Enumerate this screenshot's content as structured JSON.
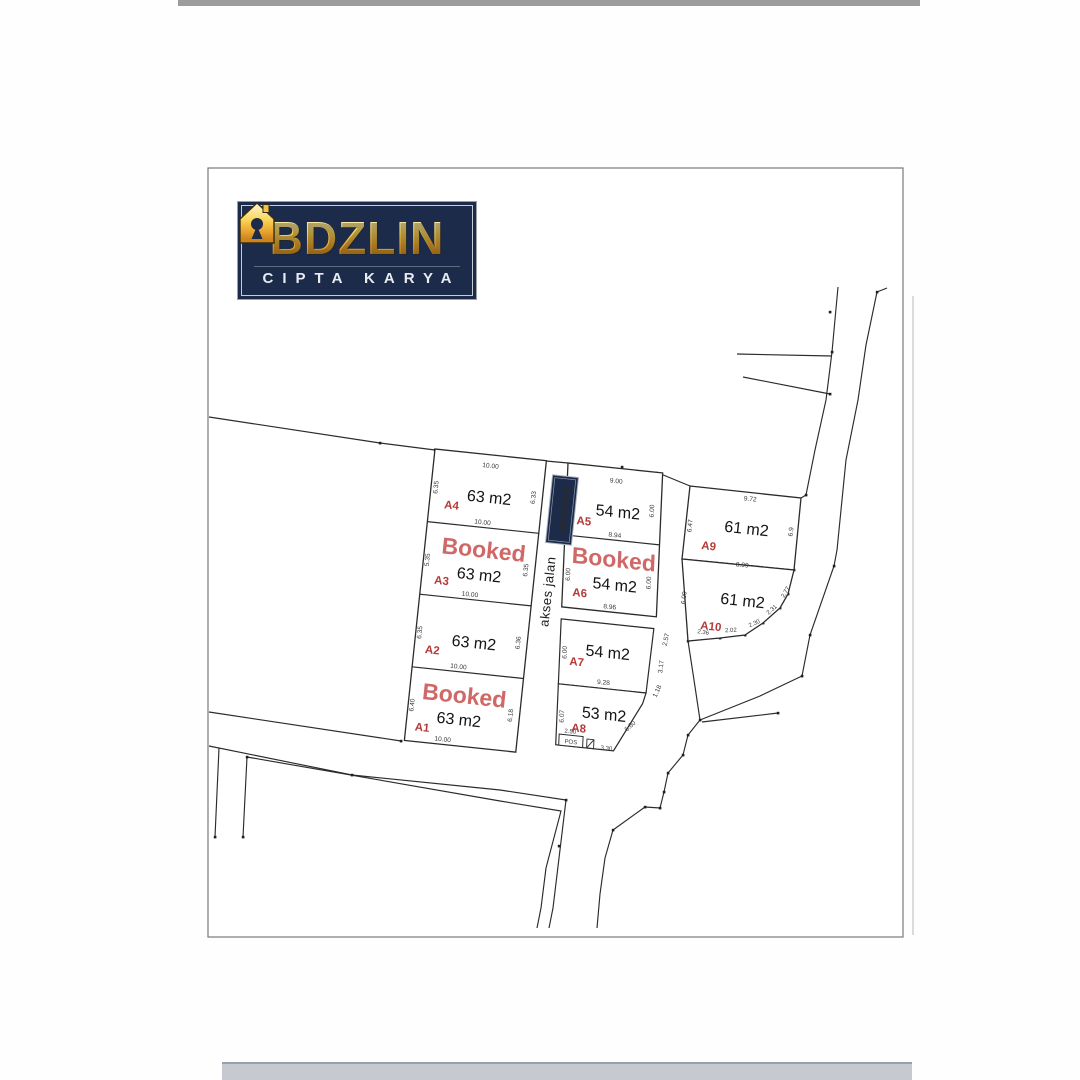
{
  "logo": {
    "brand": "BADZLIN",
    "brand_left": "B",
    "brand_right": "DZLIN",
    "tagline": "CIPTA KARYA",
    "navy": "#1c2b4a",
    "gold": "#f3c04a"
  },
  "road": {
    "access_label": "akses jalan"
  },
  "booked_label": "Booked",
  "pos_label": "POS",
  "colors": {
    "booked": "#cf6866",
    "plot_id": "#b43a38",
    "line": "#2b2b2b"
  },
  "plots": [
    {
      "id": "A1",
      "area": "63 m2",
      "booked": true,
      "left": "6.40",
      "right": "6.18",
      "bottom": "10.00"
    },
    {
      "id": "A2",
      "area": "63 m2",
      "booked": false,
      "left": "6.35",
      "right": "6.36",
      "bottom": "10.00"
    },
    {
      "id": "A3",
      "area": "63 m2",
      "booked": true,
      "left": "5.35",
      "right": "6.35",
      "bottom": "10.00"
    },
    {
      "id": "A4",
      "area": "63 m2",
      "booked": false,
      "top": "10.00",
      "left": "6.35",
      "right": "6.33",
      "bottom": "10.00"
    },
    {
      "id": "A5",
      "area": "54 m2",
      "booked": false,
      "top": "9.00",
      "left": "6.00",
      "right": "6.00",
      "bottom": "8.94"
    },
    {
      "id": "A6",
      "area": "54 m2",
      "booked": true,
      "left": "6.00",
      "right": "6.00",
      "bottom": "8.96"
    },
    {
      "id": "A7",
      "area": "54 m2",
      "booked": false,
      "left": "6.00",
      "bottom": "9.28",
      "right_segments": [
        "2.57",
        "3.17"
      ]
    },
    {
      "id": "A8",
      "area": "53 m2",
      "booked": false,
      "left": "6.07",
      "bottom_left": "2.50",
      "gate_width": "3.30",
      "diagonal": "6.60",
      "top_right": "1.18"
    },
    {
      "id": "A9",
      "area": "61 m2",
      "booked": false,
      "top": "9.72",
      "left": "6.47",
      "right": "6.9",
      "bottom": "8.99"
    },
    {
      "id": "A10",
      "area": "61 m2",
      "booked": false,
      "left": "6.00",
      "bottom_segments": [
        "2.36",
        "2.02",
        "2.30",
        "2.31",
        "2.77"
      ]
    }
  ]
}
